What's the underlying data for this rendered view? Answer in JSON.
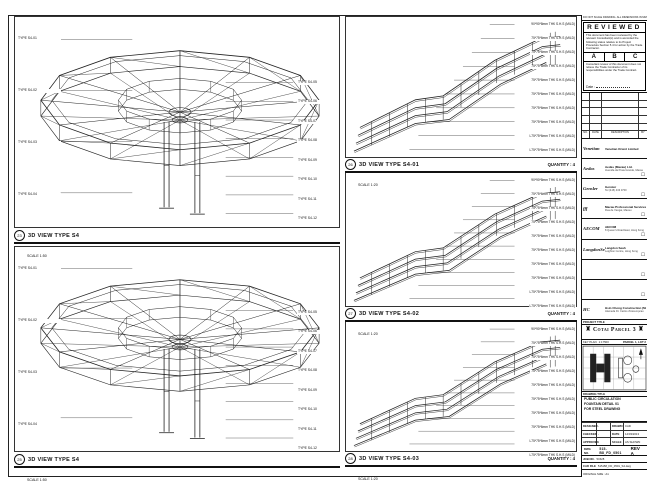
{
  "sheet": {
    "top_note": "DO NOT SCALE DRAWING. ALL DIMENSIONS IN MM U.N.O."
  },
  "left_panels": [
    {
      "bubble": "23",
      "title": "3D VIEW TYPE S4",
      "scale": "SCALE 1:50",
      "left_labels": [
        "TYPE S4-01",
        "TYPE S4-02",
        "TYPE S4-03",
        "TYPE S4-04"
      ],
      "right_labels": [
        "TYPE S4-05",
        "TYPE S4-06",
        "TYPE S4-07",
        "TYPE S4-08",
        "TYPE S4-09",
        "TYPE S4-10",
        "TYPE S4-11",
        "TYPE S4-12"
      ]
    },
    {
      "bubble": "25",
      "title": "3D VIEW TYPE S4",
      "scale": "SCALE 1:50",
      "left_labels": [
        "TYPE S4-01",
        "TYPE S4-02",
        "TYPE S4-03",
        "TYPE S4-04"
      ],
      "right_labels": [
        "TYPE S4-05",
        "TYPE S4-06",
        "TYPE S4-07",
        "TYPE S4-08",
        "TYPE S4-09",
        "TYPE S4-10",
        "TYPE S4-11",
        "TYPE S4-12"
      ]
    }
  ],
  "mid_panels": [
    {
      "bubble": "26",
      "title": "3D VIEW TYPE S4-01",
      "scale": "SCALE 1:20",
      "quantity": "QUANTITY : 4",
      "labels": [
        "90*90*8mm THK S.H.S (MILD)",
        "75*75*6mm THK S.H.S (MILD)",
        "75*75*6mm THK S.H.S (MILD)",
        "75*75*6mm THK S.H.S (MILD)",
        "75*75*6mm THK S.H.S (MILD)",
        "75*75*6mm THK S.H.S (MILD)",
        "75*75*6mm THK S.H.S (MILD)",
        "75*75*6mm THK S.H.S (MILD)",
        "L75*75*6mm THK S.H.S (MILD)",
        "L75*75*6mm THK S.H.S (MILD)"
      ]
    },
    {
      "bubble": "27",
      "title": "3D VIEW TYPE S4-02",
      "scale": "SCALE 1:20",
      "quantity": "QUANTITY : 4",
      "labels": [
        "90*90*8mm THK S.H.S (MILD)",
        "75*75*6mm THK S.H.S (MILD)",
        "75*75*6mm THK S.H.S (MILD)",
        "75*75*6mm THK S.H.S (MILD)",
        "75*75*6mm THK S.H.S (MILD)",
        "75*75*6mm THK S.H.S (MILD)",
        "75*75*6mm THK S.H.S (MILD)",
        "75*75*6mm THK S.H.S (MILD)",
        "L75*75*6mm THK S.H.S (MILD)",
        "L75*75*6mm THK S.H.S (MILD)"
      ]
    },
    {
      "bubble": "28",
      "title": "3D VIEW TYPE S4-03",
      "scale": "SCALE 1:20",
      "quantity": "QUANTITY : 4",
      "labels": [
        "90*90*8mm THK S.H.S (MILD)",
        "75*75*6mm THK S.H.S (MILD)",
        "75*75*6mm THK S.H.S (MILD)",
        "75*75*6mm THK S.H.S (MILD)",
        "75*75*6mm THK S.H.S (MILD)",
        "75*75*6mm THK S.H.S (MILD)",
        "75*75*6mm THK S.H.S (MILD)",
        "75*75*6mm THK S.H.S (MILD)",
        "L75*75*6mm THK S.H.S (MILD)",
        "L75*75*6mm THK S.H.S (MILD)"
      ]
    }
  ],
  "titleblock": {
    "review": {
      "title": "REVIEWED",
      "body1": "This document has been reviewed by the relevant Consultant(s) and is accorded the following status relative to its Project Procedure Section 5.4 for action by the Trade Contractor.",
      "options": [
        "A",
        "B",
        "C"
      ],
      "body2": "Consultant review of this document does not relieve the Trade Contractor of its responsibilities under the Trade Contract.",
      "date_label": "Date :"
    },
    "revtable": {
      "headers": [
        "NO.",
        "DATE",
        "DESCRIPTION",
        "BY"
      ]
    },
    "firms": [
      {
        "logo": "Venetian",
        "name": "Venetian Orient Limited",
        "address": "",
        "box": ""
      },
      {
        "logo": "Aedas",
        "name": "Aedas (Macau) Ltd.",
        "address": "Avenida da Praia Grande, Macau",
        "box": "☐"
      },
      {
        "logo": "Gensler",
        "name": "Gensler",
        "address": "Tel (415) 433 3700",
        "box": "☐"
      },
      {
        "logo": "fff",
        "name": "Macau Professional Services Ltd.",
        "address": "Rua de Xangai, Macau",
        "box": "☐"
      },
      {
        "logo": "AECOM",
        "name": "AECOM",
        "address": "8 Queen's Road East, Hong Kong",
        "box": "☐"
      },
      {
        "logo": "LangdonSeah",
        "name": "Langdon Seah",
        "address": "Leighton Centre, Hong Kong",
        "box": "☐"
      },
      {
        "logo": "",
        "name": "",
        "address": "",
        "box": "☐"
      },
      {
        "logo": "",
        "name": "",
        "address": "",
        "box": "☐"
      },
      {
        "logo": "HC",
        "name": "Hsin Chong Construction (Macau) Co. Ltd.",
        "address": "Alameda Dr. Carlos d'Assumpcao",
        "box": ""
      }
    ],
    "project": {
      "label": "PROJECT TITLE",
      "name": "Cotai Parcel 3",
      "tower_icon": "♜"
    },
    "keyplan": {
      "label": "KEY PLAN",
      "scale": "1:17500",
      "parcel": "PARCEL 1, LOT 2"
    },
    "drawing": {
      "label": "DRAWING TITLE",
      "lines": [
        "PUBLIC CIRCULATION",
        "FOUNTAIN DETAIL 01",
        "FOR STEEL DRAWING"
      ]
    },
    "info_rows": [
      {
        "k1": "DESIGNED",
        "v1": "-",
        "k2": "DRAWN",
        "v2": "CAD"
      },
      {
        "k1": "CHECKED",
        "v1": "-",
        "k2": "DATE",
        "v2": "14/03/2013"
      },
      {
        "k1": "APPROVED",
        "v1": "-",
        "k2": "SCALE",
        "v2": "AS SHOWN"
      }
    ],
    "dwg": {
      "label": "DWG NO.",
      "value": "515-B8_FD_0501",
      "rev_label": "REV",
      "rev": "A"
    },
    "job": {
      "label": "JOB NO.",
      "value": "51528"
    },
    "cad": {
      "label": "CAD FILE",
      "value": "515-B8_FD_0501_S4.dwg"
    },
    "size_note": "ORIGINAL SIZE : A1"
  }
}
